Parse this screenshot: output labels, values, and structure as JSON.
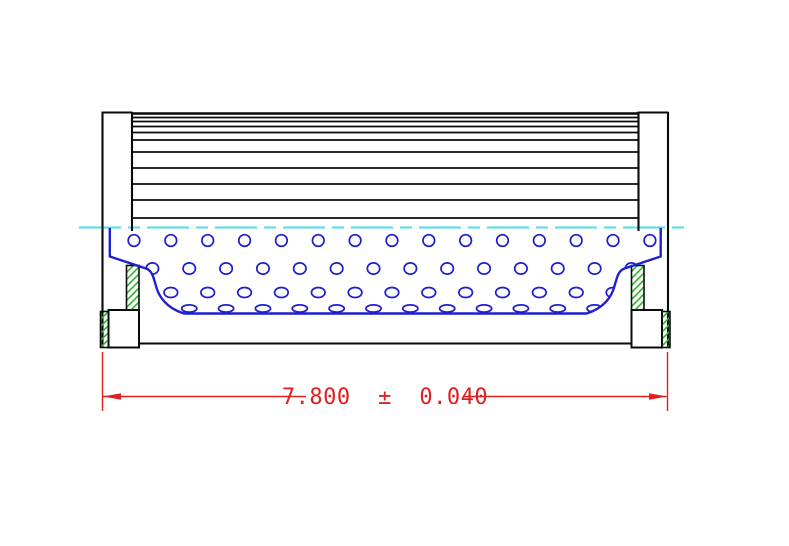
{
  "drawing": {
    "description": "Cross-section drawing of a cylindrical filter element, half view: pleated media above centerline, perforated core tube below, end caps with seal hatching, overall length dimension",
    "colors": {
      "outline": "#0a0a0a",
      "perforation_blue": "#1f1fd2",
      "centerline_cyan": "#4ae0ec",
      "seal_hatch_green": "#2db82d",
      "dimension_red": "#e01f1f",
      "background": "#ffffff"
    },
    "dimension": {
      "display": "7.800  ±  0.040",
      "value": "7.800",
      "plus_minus": "±",
      "tolerance": "0.040"
    },
    "geometry": {
      "canvas": {
        "w": 789,
        "h": 546
      },
      "pleats": {
        "x1": 132,
        "x2": 638.5,
        "ys": [
          113.5,
          117.5,
          121.5,
          126.5,
          132.5,
          140,
          152,
          168,
          184,
          200,
          218
        ]
      },
      "caps": {
        "lines": [
          [
            102.5,
            112,
            102.5,
            348
          ],
          [
            101.5,
            112.5,
            132.5,
            112.5
          ],
          [
            132,
            112,
            132,
            231
          ],
          [
            668,
            112,
            668,
            348
          ],
          [
            637.5,
            112.5,
            668.5,
            112.5
          ],
          [
            638.5,
            112,
            638.5,
            231
          ],
          [
            139,
            343.5,
            632,
            343.5
          ]
        ],
        "bottom_boxes": [
          {
            "x": 108.5,
            "y": 310,
            "w": 30.5,
            "h": 37.5
          },
          {
            "x": 631.5,
            "y": 310,
            "w": 30.5,
            "h": 37.5
          }
        ],
        "seals": [
          {
            "x": 126.5,
            "y": 265.5,
            "w": 12.5,
            "h": 44.5
          },
          {
            "x": 100.5,
            "y": 311.5,
            "w": 8,
            "h": 36
          },
          {
            "x": 631.5,
            "y": 265.5,
            "w": 12.5,
            "h": 44.5
          },
          {
            "x": 662,
            "y": 311.5,
            "w": 8,
            "h": 36
          }
        ]
      },
      "centerline": {
        "x1": 79,
        "x2": 691,
        "y": 227.5,
        "dash": "42 7 12 7"
      },
      "core": {
        "outline": "M 109.8 228 L 109.8 256.5 L 146 268.5 C 152 270.5 153.5 277 156 286 C 158.5 296 166 308 184 313.5 L 586.5 313.5 C 604.5 308 612 296 614.5 286 C 617 277 618.5 270.5 624.5 268.5 L 660.7 256.5 L 660.7 228",
        "hole_rows": [
          {
            "cy": 240.5,
            "rx": 5.8,
            "ry": 5.8,
            "x0": 134,
            "dx": 36.85,
            "count": 15
          },
          {
            "cy": 268.5,
            "rx": 6.2,
            "ry": 5.6,
            "x0": 152.4,
            "dx": 36.85,
            "count": 14
          },
          {
            "cy": 292.5,
            "rx": 6.8,
            "ry": 5.0,
            "x0": 134,
            "dx": 36.85,
            "count": 15
          },
          {
            "cy": 308.5,
            "rx": 7.6,
            "ry": 3.6,
            "x0": 152.4,
            "dx": 36.85,
            "count": 14
          }
        ]
      },
      "dim": {
        "ext": [
          [
            102.5,
            352,
            102.5,
            411
          ],
          [
            667.5,
            352,
            667.5,
            411
          ]
        ],
        "line_y": 396.5,
        "segs": [
          [
            103,
            306
          ],
          [
            464,
            666.5
          ]
        ],
        "arrows": [
          "103,396.5 121,393.2 121,399.8",
          "667,396.5 649,393.2 649,399.8"
        ]
      }
    }
  }
}
